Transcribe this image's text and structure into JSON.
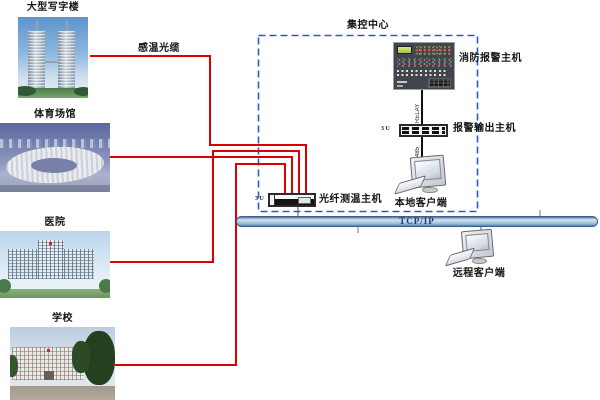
{
  "diagram": {
    "buildings": [
      {
        "id": "office",
        "label": "大型写字楼"
      },
      {
        "id": "stadium",
        "label": "体育场馆"
      },
      {
        "id": "hospital",
        "label": "医院"
      },
      {
        "id": "school",
        "label": "学校"
      }
    ],
    "cable_label": "感温光缆",
    "control_center": {
      "title": "集控中心",
      "fire_alarm_host_label": "消防报警主机",
      "relay_link_label": "RELAY",
      "alarm_output_host_label": "报警输出主机",
      "alarm_output_host_size": "3 U",
      "serial_link_label": "485",
      "local_client_label": "本地客户端",
      "temp_host_label": "光纤测温主机",
      "temp_host_size": "3 U"
    },
    "network": {
      "bus_label": "TCP/IP",
      "remote_client_label": "远程客户端"
    },
    "colors": {
      "cable": "#dd0000",
      "control_center_border": "#2b5cc4",
      "bus_border": "#3d5f86",
      "bus_fill": "#aac8e2",
      "bus_text": "#1e3c78"
    }
  }
}
